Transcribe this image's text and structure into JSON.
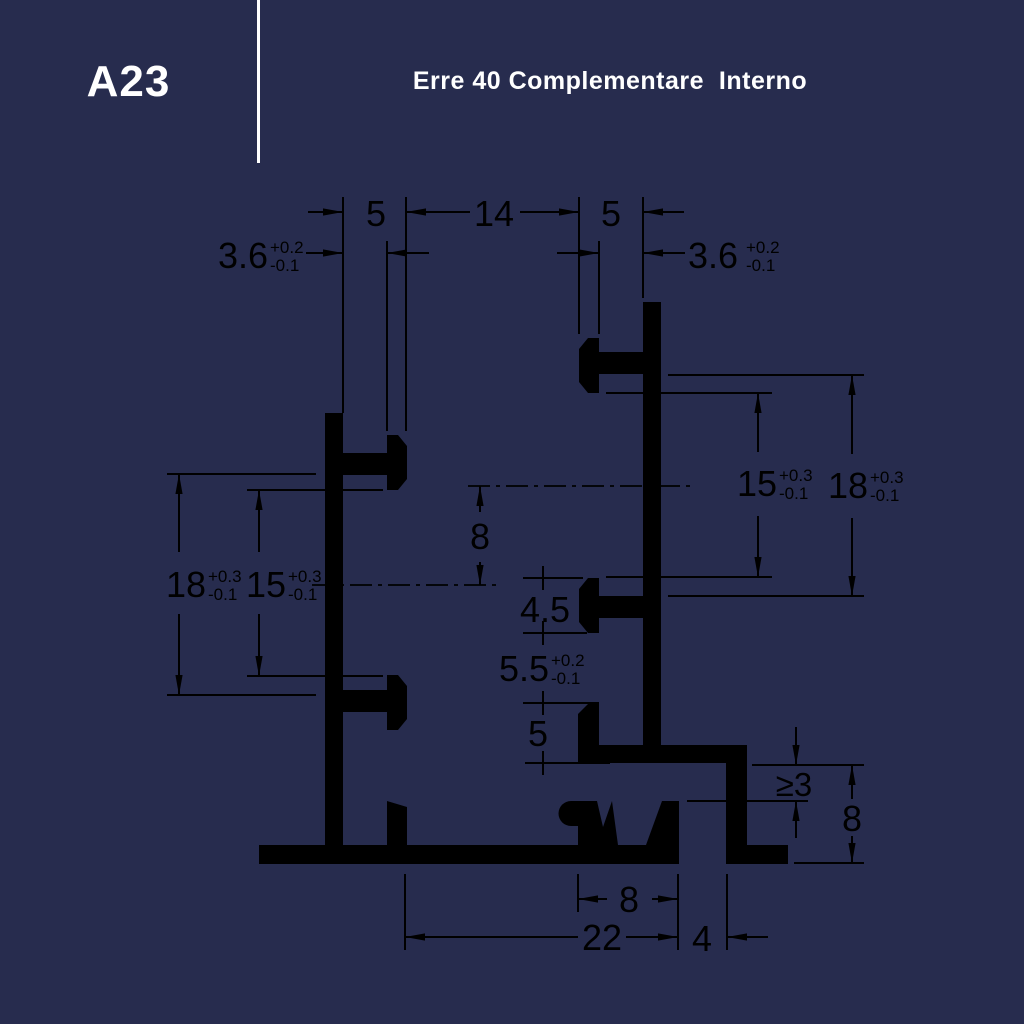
{
  "header": {
    "code": "A23",
    "title": "Erre 40 Complementare  Interno"
  },
  "colors": {
    "navy": "#272c4e",
    "ink": "#000000",
    "paper": "#ffffff"
  },
  "dimensions": {
    "top_width_left": "5",
    "top_gap": "14",
    "top_width_right": "5",
    "slot_left": {
      "value": "3.6",
      "plus": "+0.2",
      "minus": "-0.1"
    },
    "slot_right": {
      "value": "3.6",
      "plus": "+0.2",
      "minus": "-0.1"
    },
    "left_outer": {
      "value": "18",
      "plus": "+0.3",
      "minus": "-0.1"
    },
    "left_inner": {
      "value": "15",
      "plus": "+0.3",
      "minus": "-0.1"
    },
    "center_offset": "8",
    "right_inner": {
      "value": "15",
      "plus": "+0.3",
      "minus": "-0.1"
    },
    "right_outer": {
      "value": "18",
      "plus": "+0.3",
      "minus": "-0.1"
    },
    "cap_height": "4.5",
    "mid_slot": {
      "value": "5.5",
      "plus": "+0.2",
      "minus": "-0.1"
    },
    "shelf_gap": "5",
    "min_clearance": "≥3",
    "foot_height": "8",
    "base_notch": "8",
    "base_width": "22",
    "side_gap": "4"
  }
}
